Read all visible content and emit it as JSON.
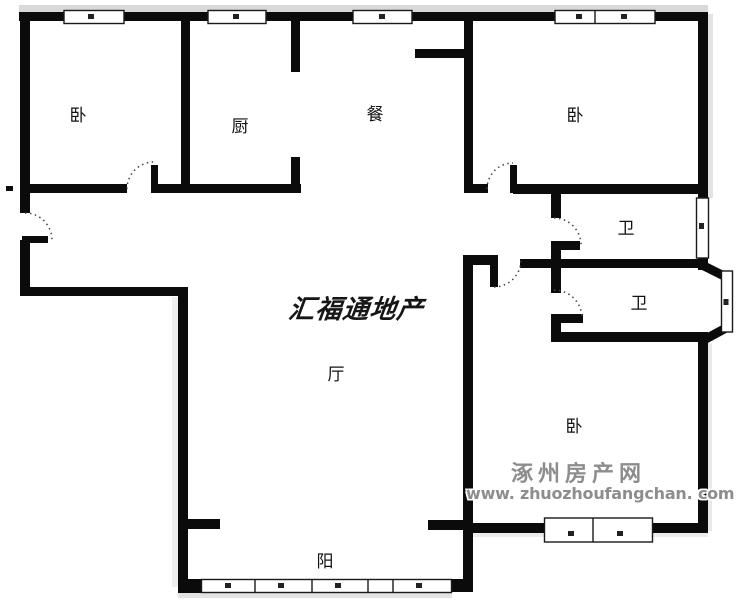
{
  "rooms": {
    "bedroom_top_left": {
      "label": "卧"
    },
    "kitchen": {
      "label": "厨"
    },
    "dining": {
      "label": "餐"
    },
    "bedroom_top_right": {
      "label": "卧"
    },
    "bathroom_upper": {
      "label": "卫"
    },
    "bathroom_lower": {
      "label": "卫"
    },
    "living_room": {
      "label": "厅"
    },
    "bedroom_bottom_right": {
      "label": "卧"
    },
    "balcony": {
      "label": "阳"
    }
  },
  "watermarks": {
    "center": "汇福通地产",
    "site_name": "涿州房产网",
    "site_url": "www. zhuozhoufangchan. com"
  },
  "colors": {
    "wall": "#0b0b0b",
    "background": "#ffffff",
    "label": "#121212",
    "watermark_center": "#161616",
    "watermark_site": "#8d8d8d"
  }
}
